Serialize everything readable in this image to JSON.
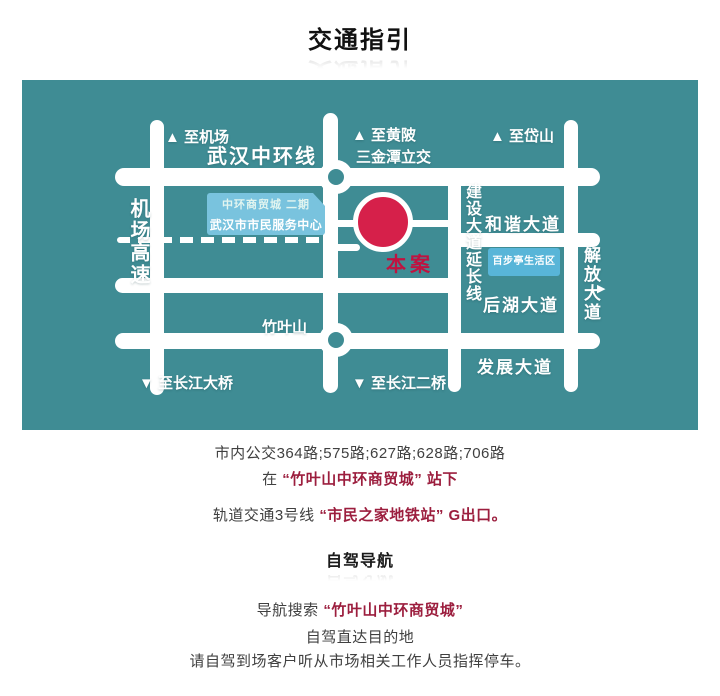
{
  "title": "交通指引",
  "colors": {
    "map_bg": "#3f8c94",
    "road": "#ffffff",
    "site_marker": "#d6204a",
    "site_text": "#c01240",
    "highlight_text": "#9c1e3e",
    "body_text": "#404040",
    "info_box": "#79c3de"
  },
  "map": {
    "labels": {
      "to_airport": "▲ 至机场",
      "ring_road": "武汉中环线",
      "to_huangpi": "▲ 至黄陂",
      "sanjintan_interchange": "三金潭立交",
      "to_daishan": "▲ 至岱山",
      "airport_expressway": "机场高速",
      "trade_city_phase2": "中环商贸城 二期",
      "citizen_service_center": "武汉市市民服务中心",
      "hexie_avenue": "和谐大道",
      "jianshe_extension": "建设大道延长线",
      "jiefang_avenue": "解放大道",
      "jiefang_arrow": "▶",
      "baibuting_area": "百步亭生活区",
      "houhu_avenue": "后湖大道",
      "site_marker": "本案",
      "zhuyeshan": "竹叶山",
      "fazhan_avenue": "发展大道",
      "to_yangtze_bridge": "▼ 至长江大桥",
      "to_second_yangtze_bridge": "▼ 至长江二桥"
    }
  },
  "transit": {
    "bus_line": "市内公交364路;575路;627路;628路;706路",
    "stop_prefix": "在",
    "stop_highlight": "“竹叶山中环商贸城” 站下",
    "metro_prefix": "轨道交通3号线",
    "metro_highlight": "“市民之家地铁站” G出口。"
  },
  "driving": {
    "heading": "自驾导航",
    "search_prefix": "导航搜索",
    "search_highlight": "“竹叶山中环商贸城”",
    "direct_line": "自驾直达目的地",
    "parking_line": "请自驾到场客户听从市场相关工作人员指挥停车。"
  }
}
